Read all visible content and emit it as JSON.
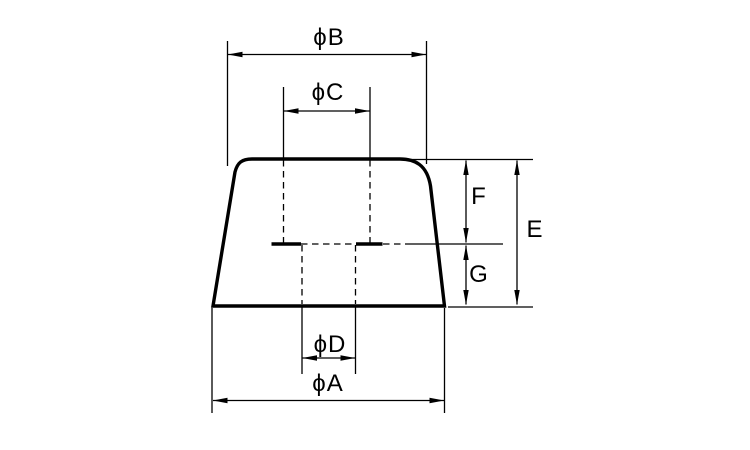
{
  "diagram": {
    "kind": "technical-dimension-drawing",
    "background_color": "#ffffff",
    "line_color": "#000000",
    "labels": {
      "diameter_b": "ϕB",
      "diameter_c": "ϕC",
      "diameter_d": "ϕD",
      "diameter_a": "ϕA",
      "height_f": "F",
      "height_g": "G",
      "height_e": "E"
    }
  }
}
